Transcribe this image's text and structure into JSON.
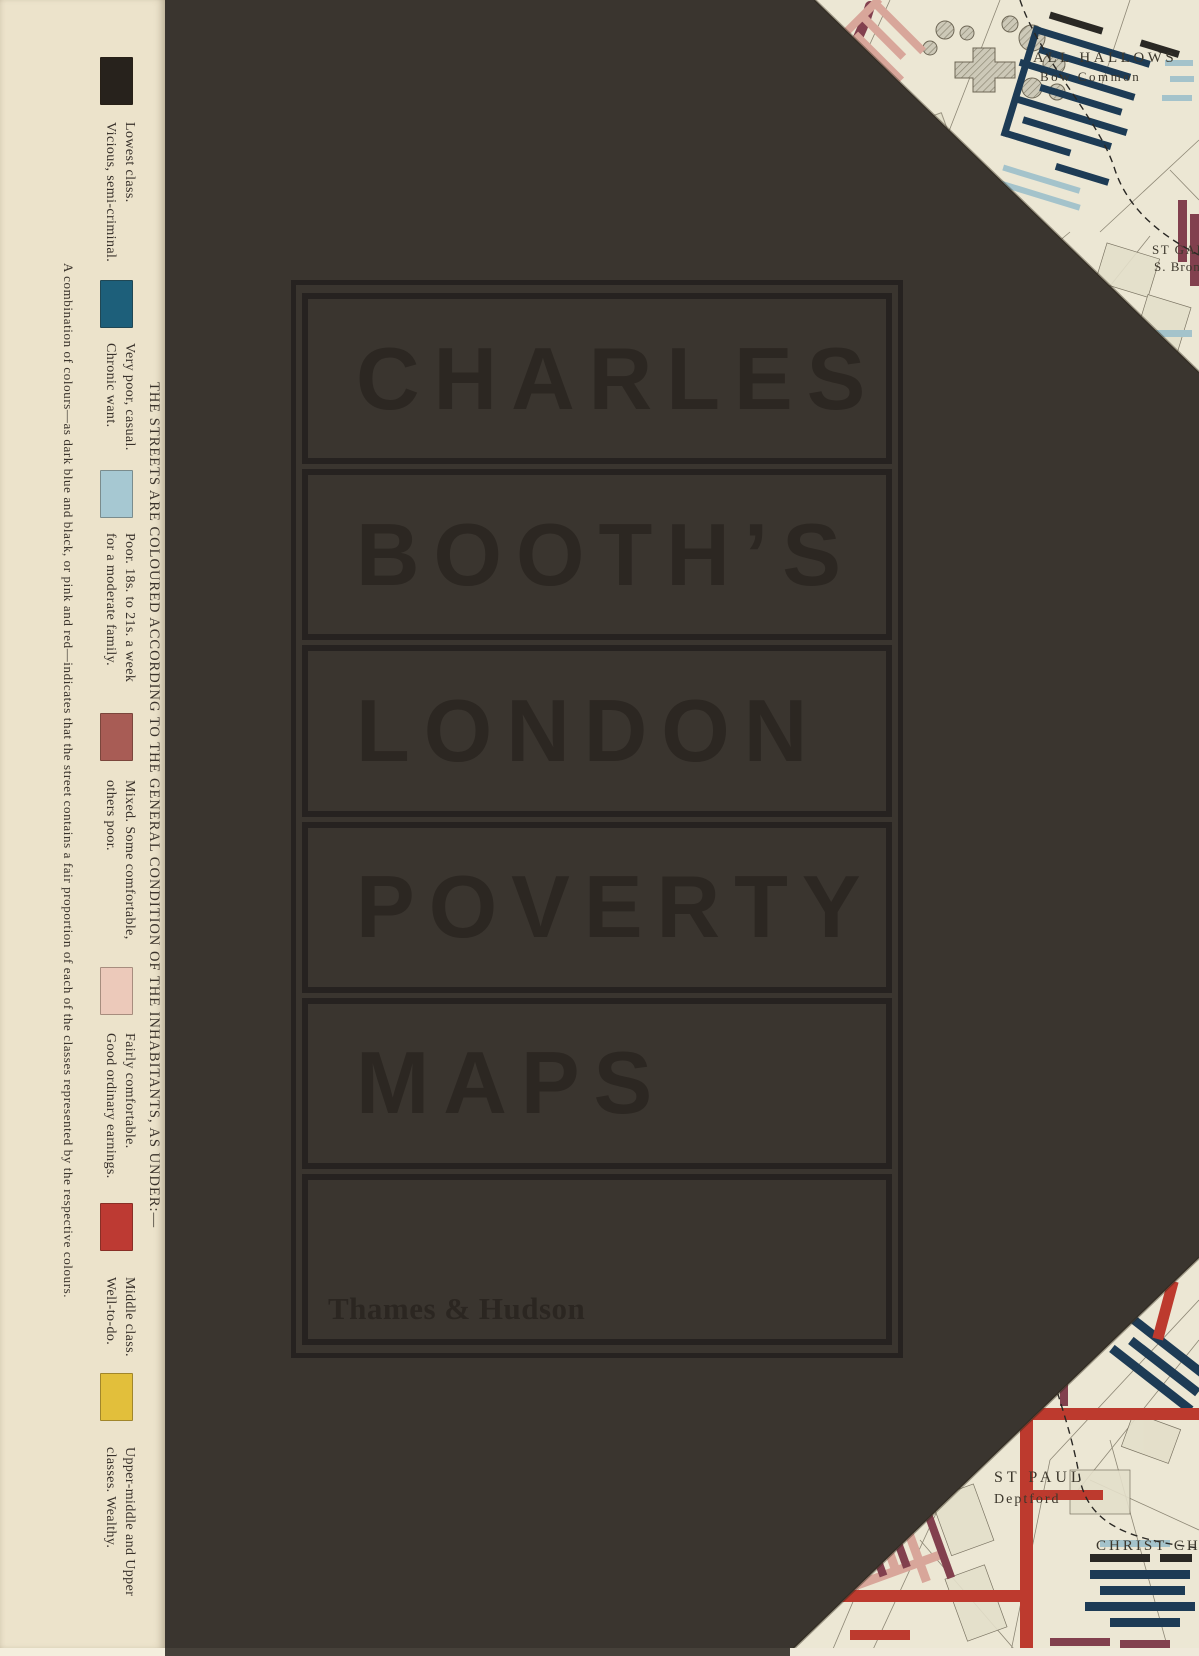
{
  "cover": {
    "title_words": [
      "CHARLES",
      "BOOTH’S",
      "LONDON",
      "POVERTY",
      "MAPS"
    ],
    "publisher": "Thames & Hudson",
    "palette": {
      "cover_background": "#3a352f",
      "title_ink": "#2c2722",
      "frame_ink": "#262220",
      "sidebar_background": "#ece3cb",
      "sidebar_ink": "#37302a",
      "map_paper": "#ece7d4",
      "map_navy": "#1d3b55",
      "map_maroon": "#82404e",
      "map_light_blue": "#a4c3cb",
      "map_pink": "#d8a69a",
      "map_red": "#bd3a2e",
      "map_black": "#2a2824",
      "map_yellow": "#e2bf3b"
    }
  },
  "sidebar": {
    "note_right": "THE STREETS ARE COLOURED ACCORDING TO THE GENERAL CONDITION OF THE INHABITANTS, AS UNDER:—",
    "note_left": "A combination of colours—as dark blue and black, or pink and red—indicates that the street contains a fair proportion of each of the classes represented by the respective colours.",
    "legend": [
      {
        "color": "#27221c",
        "lines": [
          "Lowest class.",
          "Vicious, semi-criminal."
        ]
      },
      {
        "color": "#1d5f7a",
        "lines": [
          "Very poor, casual.",
          "Chronic want."
        ]
      },
      {
        "color": "#a6c8d2",
        "lines": [
          "Poor. 18s. to 21s. a week",
          "for a moderate family."
        ]
      },
      {
        "color": "#a85c55",
        "lines": [
          "Mixed. Some comfortable,",
          "others poor."
        ]
      },
      {
        "color": "#ecc9ba",
        "lines": [
          "Fairly comfortable.",
          "Good ordinary earnings."
        ]
      },
      {
        "color": "#bd3a33",
        "lines": [
          "Middle class.",
          "Well-to-do."
        ]
      },
      {
        "color": "#e2bf3b",
        "lines": [
          "Upper-middle and Upper",
          "classes. Wealthy."
        ]
      }
    ]
  },
  "maps": {
    "top": {
      "label1_line1": "ALL HALLOWS",
      "label1_line2": "Bow Common",
      "label2_line1": "ST GABR",
      "label2_line2": "S. Brom"
    },
    "bottom": {
      "label1_line1": "ST PAUL",
      "label1_line2": "Deptford",
      "label2": "CHRIST CHU"
    }
  }
}
